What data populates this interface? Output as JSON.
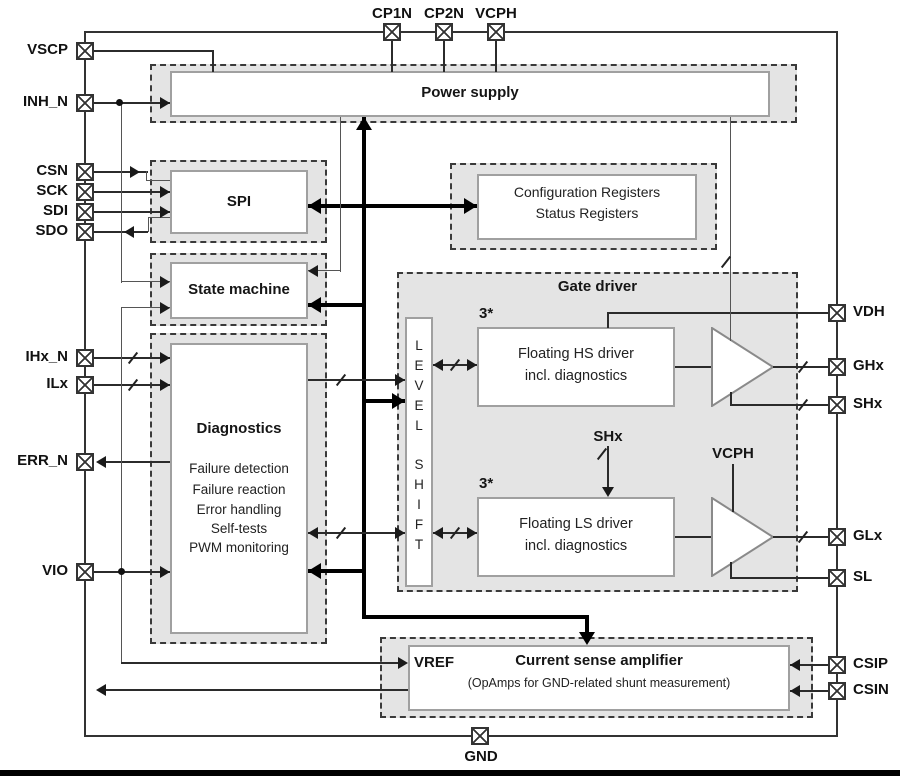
{
  "pins": {
    "left": [
      {
        "label": "VSCP"
      },
      {
        "label": "INH_N"
      },
      {
        "label": "CSN"
      },
      {
        "label": "SCK"
      },
      {
        "label": "SDI"
      },
      {
        "label": "SDO"
      },
      {
        "label": "IHx_N"
      },
      {
        "label": "ILx"
      },
      {
        "label": "ERR_N"
      },
      {
        "label": "VIO"
      }
    ],
    "top": [
      {
        "label": "CP1N"
      },
      {
        "label": "CP2N"
      },
      {
        "label": "VCPH"
      }
    ],
    "right": [
      {
        "label": "VDH"
      },
      {
        "label": "GHx"
      },
      {
        "label": "SHx"
      },
      {
        "label": "GLx"
      },
      {
        "label": "SL"
      },
      {
        "label": "CSIP"
      },
      {
        "label": "CSIN"
      }
    ],
    "bottom": [
      {
        "label": "GND"
      }
    ]
  },
  "blocks": {
    "power_supply": {
      "title": "Power supply"
    },
    "spi": {
      "title": "SPI"
    },
    "registers": {
      "line1": "Configuration Registers",
      "line2": "Status Registers"
    },
    "state_machine": {
      "title": "State machine"
    },
    "diagnostics": {
      "title": "Diagnostics",
      "items": [
        "Failure detection",
        "Failure reaction",
        "Error handling",
        "Self-tests",
        "PWM monitoring"
      ]
    },
    "gate_driver": {
      "title": "Gate driver",
      "level_shift_word1": "LEVEL",
      "level_shift_word2": "SHIFT",
      "hs_driver": {
        "multiplier": "3*",
        "line1": "Floating HS driver",
        "line2": "incl. diagnostics"
      },
      "ls_driver": {
        "multiplier": "3*",
        "line1": "Floating LS driver",
        "line2": "incl. diagnostics"
      },
      "shx_label": "SHx",
      "vcph_label": "VCPH"
    },
    "current_sense": {
      "vref_label": "VREF",
      "title": "Current sense amplifier",
      "subtitle": "(OpAmps for GND-related shunt measurement)"
    }
  },
  "colors": {
    "block_fill": "#e4e4e4",
    "dash_border": "#3a3a3a",
    "wire": "#2b2b2b",
    "bus": "#000000",
    "text": "#111111"
  }
}
